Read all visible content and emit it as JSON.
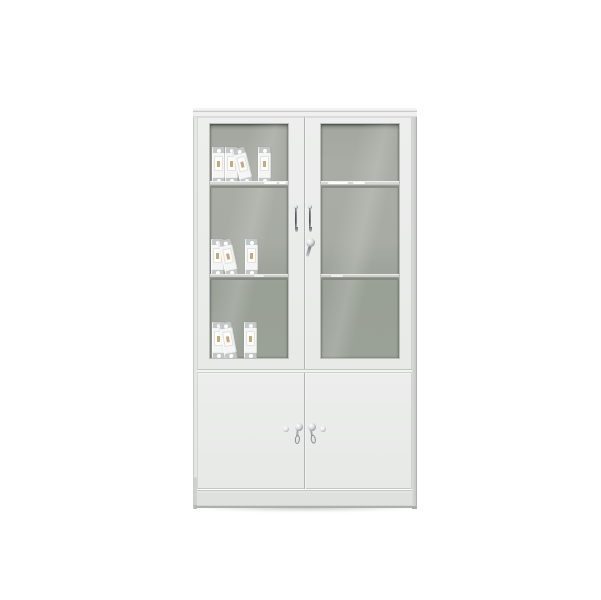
{
  "meta": {
    "description": "Product render of a light-grey steel office filing cabinet on a plain white background: two framed glass swing doors on top revealing two interior shelves with white ring binders, two solid swing doors below, chrome hardware",
    "visible_text": ""
  },
  "colors": {
    "background": "#ffffff",
    "face": "#e8eae8",
    "face-light": "#edeeed",
    "side-edge": "#b0b2b0",
    "glass-top": "#6f746e",
    "glass-upper": "#a8aca4",
    "glass-lower": "#99a096",
    "shelf-light": "#d6d9d3",
    "shelf-shadow": "#878c85",
    "binder-body": "#f4f5f4",
    "binder-cap": "#c4c7c8",
    "binder-emblem": "#bf9a63",
    "chrome-dark": "#54585c",
    "chrome-mid": "#9fa3a7",
    "base-face": "#dfe1df"
  },
  "cabinet": {
    "upper_section": {
      "left_door": {
        "type": "framed-glass",
        "handle": "chrome-wire-pull"
      },
      "right_door": {
        "type": "framed-glass",
        "handle": "chrome-wire-pull",
        "lock": "chrome-cam-lock-with-lever"
      }
    },
    "interior": {
      "shelves": 2,
      "binder_groups": [
        {
          "shelf_level": 1,
          "binders": [
            {
              "x": 2,
              "tilt": 0
            },
            {
              "x": 15,
              "tilt": 0
            },
            {
              "x": 31,
              "tilt": -14
            },
            {
              "x": 48,
              "tilt": 0
            }
          ]
        },
        {
          "shelf_level": 2,
          "binders": [
            {
              "x": 1,
              "tilt": 0
            },
            {
              "x": 16,
              "tilt": -12
            },
            {
              "x": 35,
              "tilt": 0
            }
          ]
        },
        {
          "shelf_level": 3,
          "binders": [
            {
              "x": 2,
              "tilt": 0
            },
            {
              "x": 15,
              "tilt": -10
            },
            {
              "x": 34,
              "tilt": 0
            }
          ]
        }
      ]
    },
    "lower_section": {
      "left_door": {
        "type": "solid-panel",
        "knob": "chrome-round-knob",
        "lock": "chrome-key-lock",
        "key_inserted": true
      },
      "right_door": {
        "type": "solid-panel",
        "knob": "chrome-round-knob",
        "lock": "chrome-key-lock",
        "key_inserted": true
      }
    },
    "base": {
      "type": "recessed-plinth"
    }
  }
}
